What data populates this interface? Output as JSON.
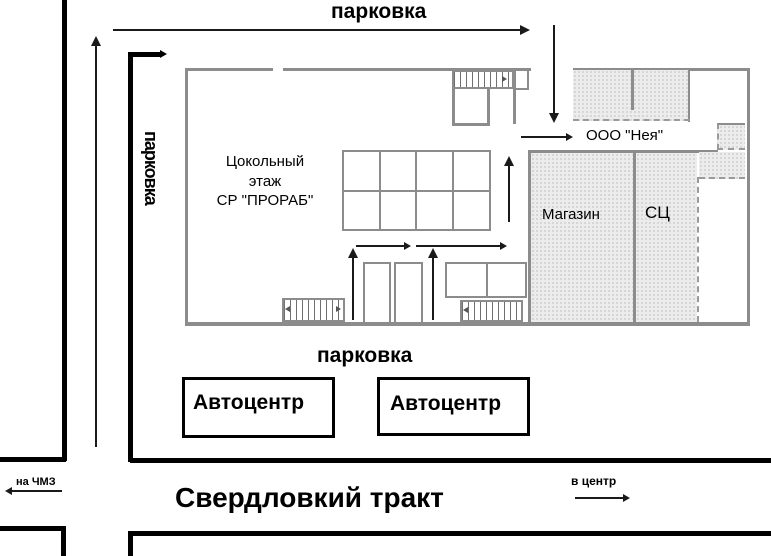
{
  "map": {
    "parking_top": "парковка",
    "parking_left": "парковка",
    "parking_bottom": "парковка",
    "basement": {
      "line1": "Цокольный",
      "line2": "этаж",
      "line3": "СР \"ПРОРАБ\""
    },
    "ooo_neya": "ООО \"Нея\"",
    "shop": "Магазин",
    "service_center": "СЦ",
    "autocenter_left": "Автоцентр",
    "autocenter_right": "Автоцентр",
    "direction_chmz": "на ЧМЗ",
    "street_name": "Свердловкий тракт",
    "direction_center": "в центр"
  },
  "icons": {
    "direction-arrows": "css-triangle",
    "stairs-pattern": "vertical-hatch",
    "room-fill": "speckled-hatch"
  },
  "colors": {
    "road": "#000000",
    "wall": "#8c8c8c",
    "room_fill": "#ececec",
    "arrow": "#1a1a1a",
    "background": "#ffffff"
  }
}
